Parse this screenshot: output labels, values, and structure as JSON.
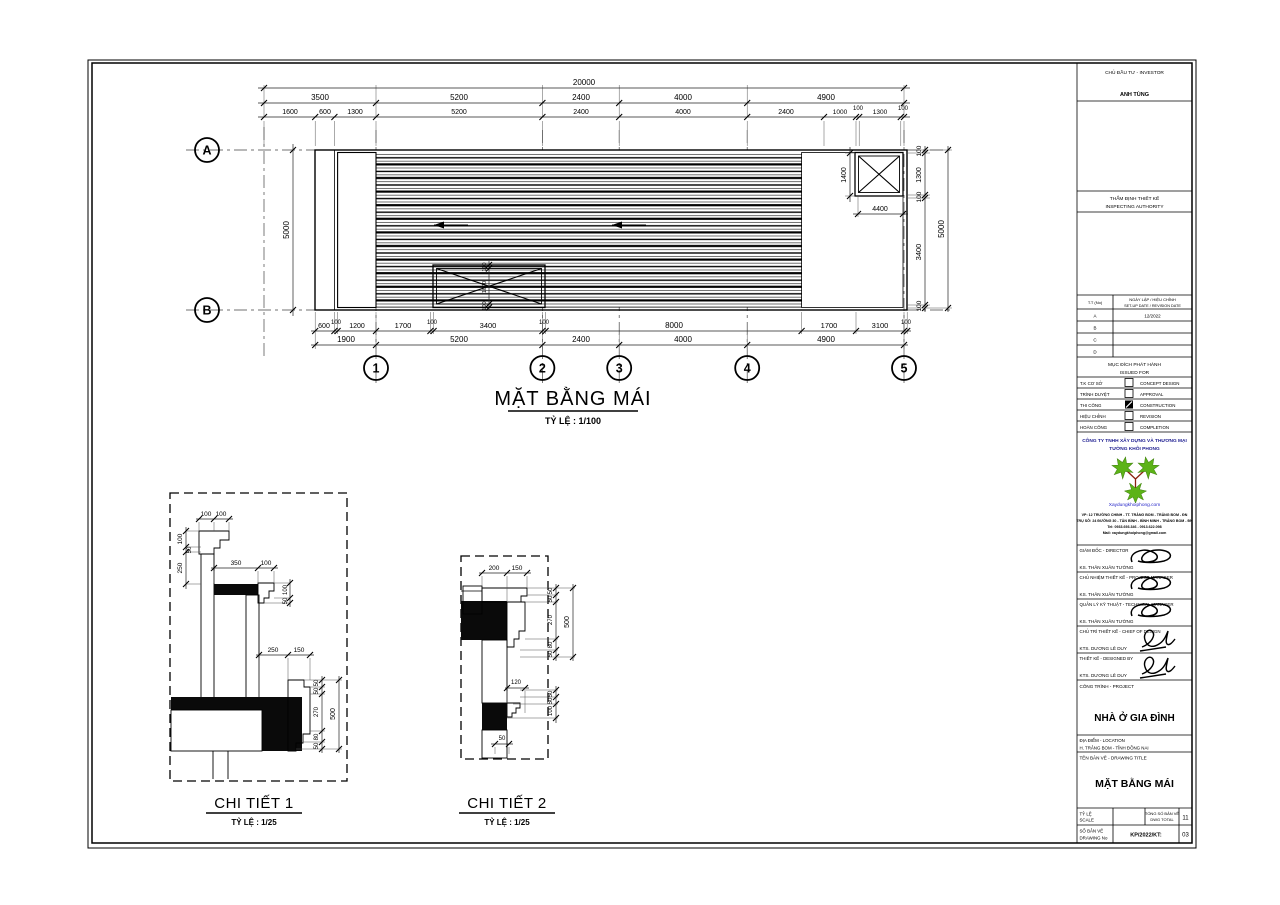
{
  "plan": {
    "title": "MẶT BẰNG MÁI",
    "scale_label": "TỶ LỆ : 1/100",
    "grids": {
      "rows": [
        "A",
        "B"
      ],
      "cols": [
        "1",
        "2",
        "3",
        "4",
        "5"
      ]
    },
    "dims": {
      "top_total": "20000",
      "top_mid": [
        "3500",
        "5200",
        "2400",
        "4000",
        "4900"
      ],
      "top_inner": [
        "1600",
        "600",
        "1300",
        "5200",
        "2400",
        "4000",
        "2400",
        "1000",
        "100",
        "1300",
        "100"
      ],
      "bottom_inner": [
        "600",
        "100",
        "1200",
        "1700",
        "100",
        "3400",
        "100",
        "8000",
        "1700",
        "3100",
        "100"
      ],
      "bottom_mid": [
        "1900",
        "5200",
        "2400",
        "4000",
        "4900"
      ],
      "left_total": "5000",
      "right_total": "5000",
      "right_inner": [
        "100",
        "1300",
        "100",
        "3400",
        "100"
      ],
      "box_h": "1400",
      "box_w": "4400",
      "skylight": [
        "100",
        "1000",
        "100"
      ]
    }
  },
  "detail1": {
    "title": "CHI TIẾT 1",
    "scale_label": "TỶ LỆ : 1/25",
    "dims": {
      "top": [
        "100",
        "100"
      ],
      "left": [
        "100",
        "50",
        "250"
      ],
      "ledge": [
        "350",
        "100"
      ],
      "ledge_right": [
        "100",
        "50"
      ],
      "cornice_top": [
        "250",
        "150"
      ],
      "right": [
        "50",
        "50",
        "270",
        "80",
        "50"
      ],
      "right_total": "500"
    }
  },
  "detail2": {
    "title": "CHI TIẾT 2",
    "scale_label": "TỶ LỆ : 1/25",
    "dims": {
      "top": [
        "200",
        "150"
      ],
      "right": [
        "50",
        "50",
        "270",
        "80",
        "50"
      ],
      "right_total": "500",
      "step": "120",
      "lower_right": [
        "50",
        "50",
        "100"
      ],
      "bottom": "50"
    }
  },
  "titleblock": {
    "investor_label": "CHỦ ĐẦU TƯ - INVESTOR",
    "investor_name": "ANH TÙNG",
    "authority_label1": "THẨM ĐỊNH THIẾT KẾ",
    "authority_label2": "INSPECTING AUTHORITY",
    "revision": {
      "col1": "T.T (No)",
      "col2a": "NGÀY LẬP / HIỆU CHỈNH",
      "col2b": "SET-UP DATE / REVISION DATE",
      "rows": [
        {
          "id": "A",
          "date": "12/2022"
        },
        {
          "id": "B",
          "date": ""
        },
        {
          "id": "C",
          "date": ""
        },
        {
          "id": "D",
          "date": ""
        }
      ]
    },
    "issued": {
      "title1": "MỤC ĐÍCH PHÁT HÀNH",
      "title2": "ISSUED FOR",
      "rows": [
        {
          "vi": "T.K CƠ SỞ",
          "en": "CONCEPT DESIGN",
          "checked": false
        },
        {
          "vi": "TRÌNH DUYỆT",
          "en": "APPROVAL",
          "checked": false
        },
        {
          "vi": "THI CÔNG",
          "en": "CONSTRUCTION",
          "checked": true
        },
        {
          "vi": "HIỆU CHỈNH",
          "en": "REVISION",
          "checked": false
        },
        {
          "vi": "HOÀN CÔNG",
          "en": "COMPLETION",
          "checked": false
        }
      ]
    },
    "company": {
      "name1": "CÔNG TY TNHH XÂY DỰNG VÀ THƯƠNG MẠI",
      "name2": "TƯỜNG KHÔI PHONG",
      "website": "Xaydungkhoiphong.com",
      "addr1": "VP: 12 TRƯỜNG CHINH - TT. TRẢNG BOM - TRẢNG BOM - ĐN",
      "addr2": "TRỤ SỞ: 24 ĐƯỜNG 30 - TÂN BÌNH - BÌNH MINH - TRẢNG BOM - ĐN",
      "addr3": "Tel: 0933.693.346 - 0913.622.098",
      "addr4": "Mail: xaydungkhoiphong@gmail.com",
      "brand_green": "#5cb317",
      "brand_blue": "#1b1b8f"
    },
    "signatures": [
      {
        "role": "GIÁM ĐỐC - DIRECTOR",
        "name": "KS. THÂN XUÂN TƯỜNG"
      },
      {
        "role": "CHỦ NHIỆM THIẾT KẾ - PROJECT MANAGER",
        "name": "KS. THÂN XUÂN TƯỜNG"
      },
      {
        "role": "QUẢN LÝ KỸ THUẬT - TECHNICAL MANAGER",
        "name": "KS. THÂN XUÂN TƯỜNG"
      },
      {
        "role": "CHỦ TRÌ THIẾT KẾ - CHIEF OF DESIGN",
        "name": "KTS. DƯƠNG LÊ DUY"
      },
      {
        "role": "THIẾT KẾ - DESIGNED BY",
        "name": "KTS. DƯƠNG LÊ DUY"
      }
    ],
    "project": {
      "label": "CÔNG TRÌNH - PROJECT",
      "name": "NHÀ Ở GIA ĐÌNH"
    },
    "location": {
      "label": "ĐỊA ĐIỂM - LOCATION",
      "value": "H. TRẢNG BOM - TỈNH ĐỒNG NAI"
    },
    "drawing_title": {
      "label": "TÊN BẢN VẼ - DRAWING TITLE",
      "value": "MẶT BẰNG MÁI"
    },
    "footer": {
      "scale_label1": "TỶ LỆ",
      "scale_label2": "SCALE",
      "total_label1": "TỔNG SỐ BẢN VẼ",
      "total_label2": "DWG TOTAL",
      "total_value": "11",
      "no_label1": "SỐ BẢN VẼ",
      "no_label2": "DRAWING No",
      "no_value": "KP/2022/KT:",
      "no_number": "03"
    }
  }
}
